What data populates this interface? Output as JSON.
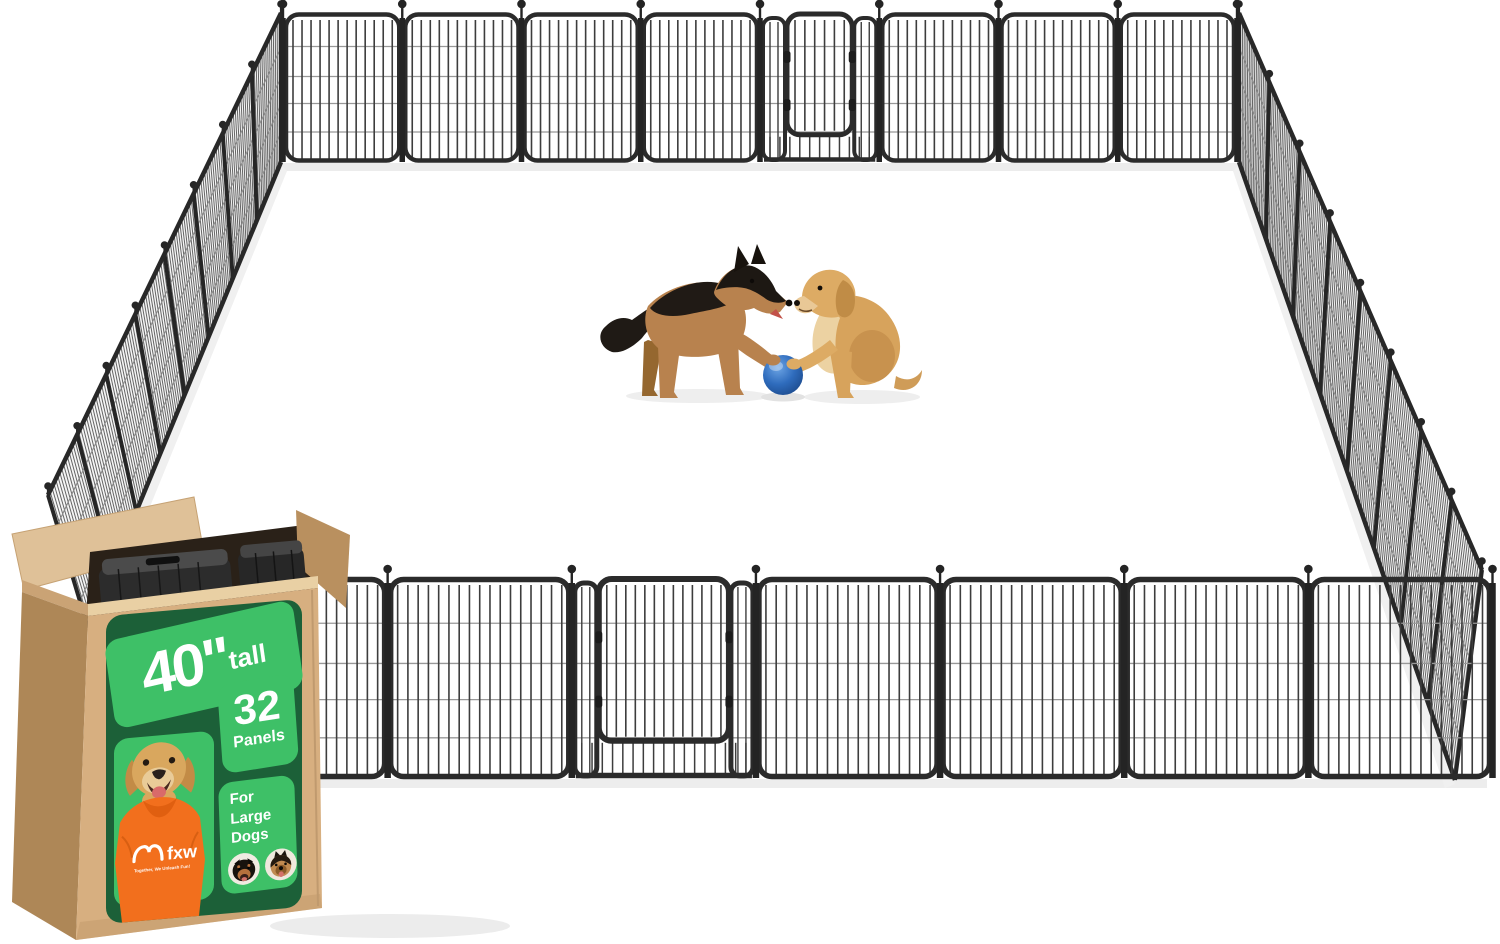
{
  "scene": {
    "fence": {
      "total_panels": 32,
      "back_panels": 8,
      "front_panels": 7,
      "left_panels": 8,
      "right_panels": 8,
      "gates": 2,
      "frame_color": "#2b2b2b",
      "bar_color": "#3d3d3d",
      "wire_color": "#989898"
    },
    "dogs": [
      {
        "breed": "german-shepherd",
        "pose": "standing-paw-on-ball"
      },
      {
        "breed": "golden-retriever",
        "pose": "sitting-paw-on-ball"
      }
    ],
    "ball": {
      "type": "ball",
      "color": "#2f6cbd"
    }
  },
  "box_label": {
    "height_value": "40\"",
    "height_unit": "tall",
    "panel_count": "32",
    "panel_word": "Panels",
    "for_line": "For",
    "size_line": "Large",
    "species_line": "Dogs",
    "brand": "fxw",
    "tagline": "Together, We Unleash Fun!"
  },
  "colors": {
    "label_dark_green": "#1c6038",
    "label_bright_green": "#3ec067",
    "cardboard_front": "#d7af80",
    "cardboard_side": "#ae8757",
    "cardboard_flap": "#dfc198",
    "shirt_orange": "#f26f1d"
  }
}
